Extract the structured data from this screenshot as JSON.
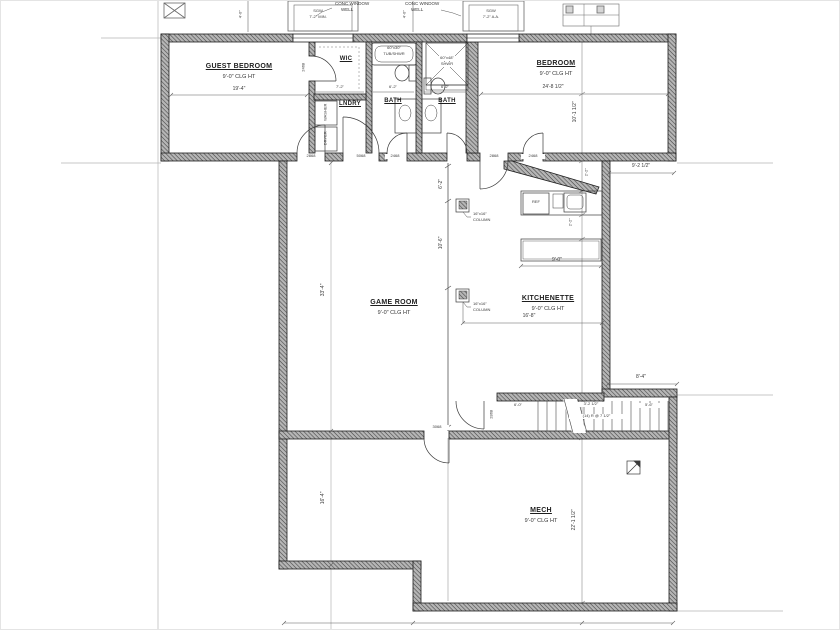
{
  "rooms": {
    "guest_bedroom": {
      "name": "GUEST BEDROOM",
      "clg": "9'-0\" CLG HT"
    },
    "wic": {
      "name": "WIC"
    },
    "lndry": {
      "name": "LNDRY"
    },
    "bath1": {
      "name": "BATH"
    },
    "bath2": {
      "name": "BATH"
    },
    "bedroom": {
      "name": "BEDROOM",
      "clg": "9'-0\" CLG HT"
    },
    "game_room": {
      "name": "GAME ROOM",
      "clg": "9'-0\" CLG HT"
    },
    "kitchenette": {
      "name": "KITCHENETTE",
      "clg": "9'-0\" CLG HT"
    },
    "mech": {
      "name": "MECH",
      "clg": "9'-0\" CLG HT"
    }
  },
  "fixtures": {
    "tub": {
      "size": "60\"x30\"",
      "label": "TUB/SHWR"
    },
    "shower": {
      "size": "60\"x48\"",
      "label": "SHWR"
    },
    "fridge": "REF",
    "washer": "WASHER",
    "dryer": "DRYER",
    "column1": {
      "size": "16\"x16\"",
      "label": "COLUMN"
    },
    "column2": {
      "size": "16\"x16\"",
      "label": "COLUMN"
    }
  },
  "windows": {
    "well_note1": {
      "line1": "CONC WINDOW",
      "line2": "WELL"
    },
    "well_note2": {
      "line1": "CONC WINDOW",
      "line2": "WELL"
    },
    "sgw1": {
      "line1": "SGW",
      "line2": "7'-2\" MIN."
    },
    "sgw2": {
      "line1": "SGW",
      "line2": "7'-2\" A.A."
    }
  },
  "doors": {
    "guest": "2868",
    "laundry": "5068",
    "bath1": "2468",
    "wic": "2468",
    "hall": "2868",
    "bedroom": "2468",
    "mech": "3068",
    "stair": "2868"
  },
  "stairs": {
    "note": "(14) R @ 7 1/2\"",
    "dim1": "6'-0\"",
    "dim2": "3'-2 1/2\"",
    "dim3": "5'-6\""
  },
  "dimensions": {
    "guest_width": "19'-4\"",
    "bedroom_width": "24'-8 1/2\"",
    "bedroom_depth": "10'-1 1/2\"",
    "kitchenette_offset": "9'-2 1/2\"",
    "stair_offset": "8'-4\"",
    "game_height": "33'-4\"",
    "mech_left": "16'-4\"",
    "mech_depth": "22'-1 1/2\"",
    "beam_upper": "6'-2\"",
    "beam_mid": "10'-6\"",
    "counter1": "2'-2\"",
    "counter2": "2'-2\"",
    "island": "9'-0\"",
    "kitchen_width": "16'-8\"",
    "wic_width": "7'-2\"",
    "bath1_width": "6'-2\"",
    "bath2_width": "6'-2\"",
    "well1_off": "4'-0\"",
    "well2_off": "4'-0\""
  }
}
